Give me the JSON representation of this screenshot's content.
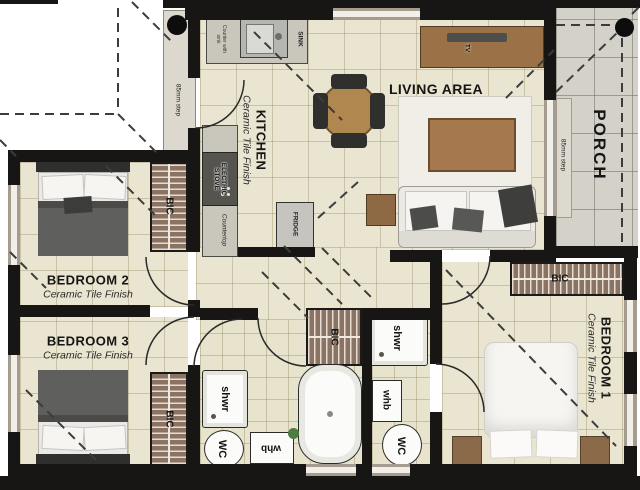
{
  "plan": {
    "title": "3 bedroom house floor plan",
    "rooms": {
      "kitchen": {
        "name": "KITCHEN",
        "finish": "Ceramic Tile Finish"
      },
      "living": {
        "name": "LIVING AREA"
      },
      "porch": {
        "name": "PORCH"
      },
      "bedroom1": {
        "name": "BEDROOM 1",
        "finish": "Ceramic Tile Finish"
      },
      "bedroom2": {
        "name": "BEDROOM 2",
        "finish": "Ceramic Tile Finish"
      },
      "bedroom3": {
        "name": "BEDROOM 3",
        "finish": "Ceramic Tile Finish"
      }
    },
    "labels": {
      "bic": "BIC",
      "shwr": "shwr",
      "wc": "WC",
      "whb": "whb",
      "sink": "SINK",
      "electric_stove": "ELECTRIC STOVE",
      "countertop": "Countertop",
      "counter_note": "Counter with sink",
      "fridge": "FRIDGE",
      "tv": "TV",
      "step": "85mm step"
    },
    "colors": {
      "wall": "#181614",
      "floor_tile": "#e9e5d0",
      "bath_tile": "#e7e3cc",
      "porch_tile": "#d4d1c8",
      "cupboard_brown": "#8b7363",
      "wood": "#a5794d",
      "dark_furniture": "#4c4c4a",
      "white_fixture": "#fbfbf9"
    }
  }
}
